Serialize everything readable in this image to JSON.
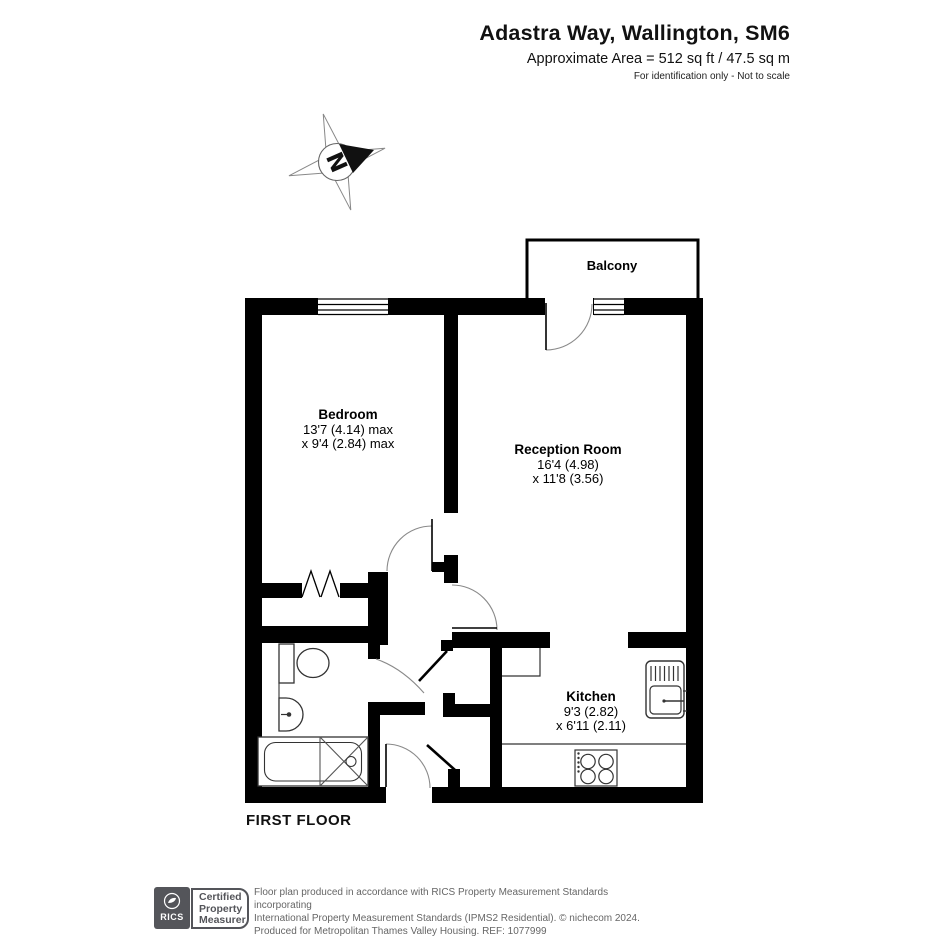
{
  "header": {
    "title": "Adastra Way, Wallington, SM6",
    "area": "Approximate Area = 512 sq ft / 47.5 sq m",
    "disclaimer": "For identification only - Not to scale"
  },
  "compass": {
    "label": "N"
  },
  "plan": {
    "balcony_label": "Balcony",
    "rooms": {
      "bedroom": {
        "name": "Bedroom",
        "dim1": "13'7 (4.14) max",
        "dim2": "x 9'4 (2.84) max"
      },
      "reception": {
        "name": "Reception Room",
        "dim1": "16'4 (4.98)",
        "dim2": "x 11'8 (3.56)"
      },
      "kitchen": {
        "name": "Kitchen",
        "dim1": "9'3 (2.82)",
        "dim2": "x 6'11 (2.11)"
      }
    },
    "floor_label": "FIRST FLOOR"
  },
  "footer": {
    "rics_logo": "RICS",
    "badge": {
      "line1": "Certified",
      "line2": "Property",
      "line3": "Measurer"
    },
    "text_line1": "Floor plan produced in accordance with RICS Property Measurement Standards incorporating",
    "text_line2": "International Property Measurement Standards (IPMS2 Residential).  © nichecom 2024.",
    "text_line3": "Produced for Metropolitan Thames Valley Housing.   REF:  1077999"
  },
  "colors": {
    "wall": "#000000",
    "footer_gray": "#54555A"
  }
}
